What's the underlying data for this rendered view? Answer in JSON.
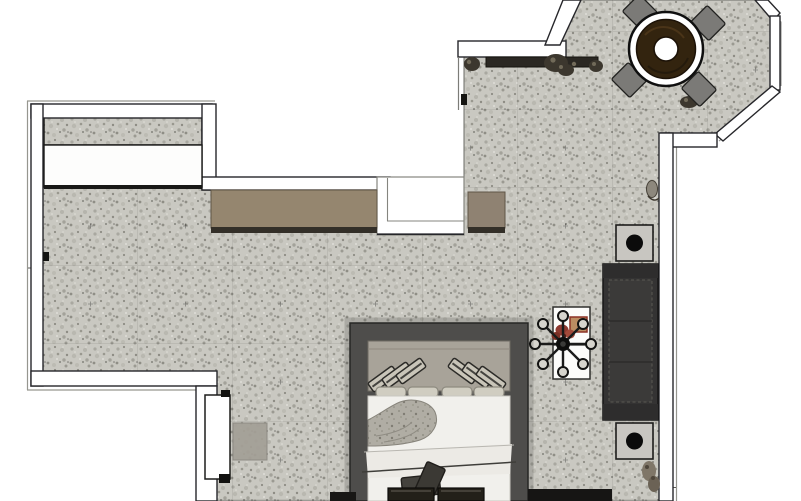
{
  "scene": {
    "kind": "3D-rendered top-down interior floor plan",
    "areas": [
      "entry with wardrobe and counter",
      "main living-sleeping room",
      "octagonal dining bay window"
    ]
  },
  "colors": {
    "void": "#ffffff",
    "floor_base": "#c9c8c1",
    "floor_speck_dark": "#8d8c84",
    "floor_speck_mid": "#a9a8a0",
    "floor_speck_light": "#e5e4de",
    "wall_fill": "#ffffff",
    "wall_edge": "#26262a",
    "wall_edge_gray": "#96968f",
    "closet_white": "#fdfdfc",
    "counter_top": "#95866f",
    "counter_shadow": "#332f28",
    "shelf_dark": "#2b2823",
    "plant_dark": "#3c372e",
    "plant_light": "#716a59",
    "table_ring": "#ffffff",
    "table_wood": "#33240f",
    "table_wood_edge": "#1c1207",
    "chair_gray": "#7b7a77",
    "sofa_body": "#343333",
    "sofa_seat": "#3b3a39",
    "sofa_arm": "#2e2d2d",
    "side_table": "#c8c6c1",
    "lamp_black": "#0b0b0b",
    "bed_frame": "#4e4d4b",
    "headboard": "#a8a399",
    "pillow_face": "#c9c5b9",
    "pillow_edge": "#2c2b28",
    "pillow_low": "#d0cdc1",
    "duvet": "#f1f0ec",
    "swirl_gray": "#b0ada4",
    "blanket": "#eceae5",
    "cushion_dark": "#44423d",
    "bench_dark": "#232019",
    "door_white": "#ffffff",
    "mat_gray": "#a39f96",
    "desk_white": "#fcfcfa",
    "flower_red": "#8e3a30",
    "flower_red2": "#a34a3a",
    "box_tan": "#bb8d62",
    "box_edge": "#8c3225"
  },
  "furniture": {
    "dining_set": {
      "label": "round dark-wood pedestal table",
      "chairs": 4
    },
    "counter": {
      "label": "taupe wall counter",
      "sections": 2
    },
    "closet": {
      "label": "built-in wardrobe strip"
    },
    "window_shelf": {
      "label": "dark shelf with plants",
      "plants": 3
    },
    "bed": {
      "label": "double bed",
      "angled_pillows": 6,
      "base_pillows": 4,
      "accent_cushions": 2,
      "foot_pads": 2
    },
    "sofa": {
      "label": "charcoal sofa",
      "side_tables": 2,
      "lamps": 2
    },
    "desk": {
      "label": "white desk with swivel chair",
      "chair_casters": 8,
      "items": [
        "red flowers",
        "tan box"
      ]
    },
    "door": {
      "label": "open door leaf with floor mat"
    },
    "accent_plants": 2
  }
}
